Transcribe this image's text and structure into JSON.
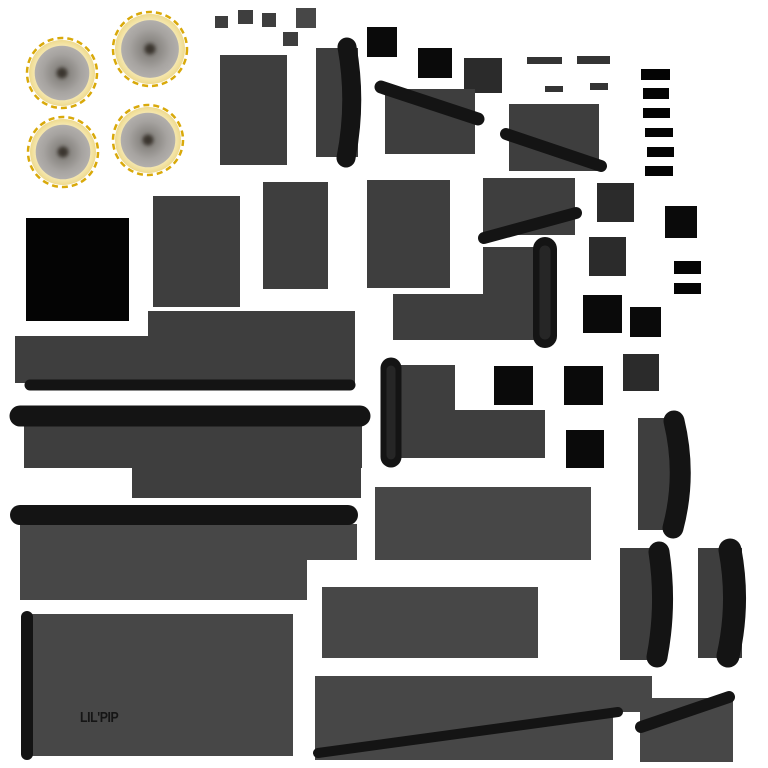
{
  "canvas": {
    "width": 768,
    "height": 768,
    "background": "#ffffff"
  },
  "palette": {
    "panel": "#3e3e3e",
    "panel_light": "#474747",
    "dark_square": "#2b2b2b",
    "black": "#0a0a0a",
    "black_deep": "#040404",
    "bar": "#141414",
    "bar_soft": "#262626",
    "strip": "#343434",
    "gold": "#d9a90a",
    "ring_cream": "#f6e9b4",
    "cone_gray": "#a6a3a0",
    "label_color": "#151515"
  },
  "label": {
    "text": "LIL'PIP"
  },
  "speakers": [
    {
      "cx": 62,
      "cy": 73,
      "r": 35,
      "rot": 25
    },
    {
      "cx": 150,
      "cy": 49,
      "r": 37,
      "rot": 35
    },
    {
      "cx": 63,
      "cy": 152,
      "r": 35,
      "rot": 30
    },
    {
      "cx": 148,
      "cy": 140,
      "r": 35,
      "rot": 20
    }
  ],
  "shapes": [
    {
      "n": "chip-a",
      "t": "rect",
      "x": 215,
      "y": 16,
      "w": 13,
      "h": 12,
      "c": "panel"
    },
    {
      "n": "chip-b",
      "t": "rect",
      "x": 238,
      "y": 10,
      "w": 15,
      "h": 14,
      "c": "panel"
    },
    {
      "n": "chip-c",
      "t": "rect",
      "x": 262,
      "y": 13,
      "w": 14,
      "h": 14,
      "c": "panel"
    },
    {
      "n": "chip-d",
      "t": "rect",
      "x": 296,
      "y": 8,
      "w": 20,
      "h": 20,
      "c": "panel_light"
    },
    {
      "n": "chip-e",
      "t": "rect",
      "x": 283,
      "y": 32,
      "w": 15,
      "h": 14,
      "c": "panel"
    },
    {
      "n": "panel-tall-left",
      "t": "rect",
      "x": 220,
      "y": 55,
      "w": 67,
      "h": 110,
      "c": "panel"
    },
    {
      "n": "strip-a",
      "t": "rect",
      "x": 527,
      "y": 57,
      "w": 35,
      "h": 7,
      "c": "strip"
    },
    {
      "n": "strip-b",
      "t": "rect",
      "x": 577,
      "y": 56,
      "w": 33,
      "h": 8,
      "c": "strip"
    },
    {
      "n": "strip-c",
      "t": "rect",
      "x": 545,
      "y": 86,
      "w": 18,
      "h": 6,
      "c": "strip"
    },
    {
      "n": "strip-d",
      "t": "rect",
      "x": 590,
      "y": 83,
      "w": 18,
      "h": 7,
      "c": "strip"
    },
    {
      "n": "square-dark-a",
      "t": "rect",
      "x": 464,
      "y": 58,
      "w": 38,
      "h": 35,
      "c": "dark_square"
    },
    {
      "n": "square-black-a",
      "t": "rect",
      "x": 367,
      "y": 27,
      "w": 30,
      "h": 30,
      "c": "black"
    },
    {
      "n": "square-black-b",
      "t": "rect",
      "x": 418,
      "y": 48,
      "w": 34,
      "h": 30,
      "c": "black"
    },
    {
      "n": "panel-mid-a",
      "t": "rect",
      "x": 385,
      "y": 89,
      "w": 90,
      "h": 65,
      "c": "panel"
    },
    {
      "n": "panel-mid-b",
      "t": "rect",
      "x": 509,
      "y": 104,
      "w": 90,
      "h": 67,
      "c": "panel"
    },
    {
      "n": "rung-1",
      "t": "rect",
      "x": 641,
      "y": 69,
      "w": 29,
      "h": 11,
      "c": "black_deep"
    },
    {
      "n": "rung-2",
      "t": "rect",
      "x": 643,
      "y": 88,
      "w": 26,
      "h": 11,
      "c": "black_deep"
    },
    {
      "n": "rung-3",
      "t": "rect",
      "x": 643,
      "y": 108,
      "w": 27,
      "h": 10,
      "c": "black_deep"
    },
    {
      "n": "rung-4",
      "t": "rect",
      "x": 645,
      "y": 128,
      "w": 28,
      "h": 9,
      "c": "black_deep"
    },
    {
      "n": "rung-5",
      "t": "rect",
      "x": 647,
      "y": 147,
      "w": 27,
      "h": 10,
      "c": "black_deep"
    },
    {
      "n": "rung-6",
      "t": "rect",
      "x": 645,
      "y": 166,
      "w": 28,
      "h": 10,
      "c": "black_deep"
    },
    {
      "n": "panel-row2-a",
      "t": "rect",
      "x": 153,
      "y": 196,
      "w": 87,
      "h": 111,
      "c": "panel"
    },
    {
      "n": "panel-row2-b",
      "t": "rect",
      "x": 263,
      "y": 182,
      "w": 65,
      "h": 107,
      "c": "panel"
    },
    {
      "n": "panel-row2-c",
      "t": "rect",
      "x": 367,
      "y": 180,
      "w": 83,
      "h": 108,
      "c": "panel"
    },
    {
      "n": "panel-row2-d",
      "t": "rect",
      "x": 483,
      "y": 178,
      "w": 92,
      "h": 57,
      "c": "panel"
    },
    {
      "n": "square-dark-b",
      "t": "rect",
      "x": 597,
      "y": 183,
      "w": 37,
      "h": 39,
      "c": "dark_square"
    },
    {
      "n": "square-black-c",
      "t": "rect",
      "x": 665,
      "y": 206,
      "w": 32,
      "h": 32,
      "c": "black"
    },
    {
      "n": "square-dark-c",
      "t": "rect",
      "x": 589,
      "y": 237,
      "w": 37,
      "h": 39,
      "c": "dark_square"
    },
    {
      "n": "tab-black-a",
      "t": "rect",
      "x": 674,
      "y": 261,
      "w": 27,
      "h": 13,
      "c": "black_deep"
    },
    {
      "n": "tab-black-b",
      "t": "rect",
      "x": 674,
      "y": 283,
      "w": 27,
      "h": 11,
      "c": "black_deep"
    },
    {
      "n": "square-black-large",
      "t": "rect",
      "x": 26,
      "y": 218,
      "w": 103,
      "h": 103,
      "c": "black_deep"
    },
    {
      "n": "bracket-vertical",
      "t": "rect",
      "x": 483,
      "y": 247,
      "w": 58,
      "h": 93,
      "c": "panel"
    },
    {
      "n": "bracket-horizontal",
      "t": "rect",
      "x": 393,
      "y": 294,
      "w": 148,
      "h": 46,
      "c": "panel"
    },
    {
      "n": "panel-band-a",
      "t": "rect",
      "x": 148,
      "y": 311,
      "w": 207,
      "h": 70,
      "c": "panel"
    },
    {
      "n": "panel-band-b",
      "t": "rect",
      "x": 15,
      "y": 336,
      "w": 340,
      "h": 47,
      "c": "panel"
    },
    {
      "n": "square-black-d",
      "t": "rect",
      "x": 583,
      "y": 295,
      "w": 39,
      "h": 38,
      "c": "black"
    },
    {
      "n": "square-black-e",
      "t": "rect",
      "x": 630,
      "y": 307,
      "w": 31,
      "h": 30,
      "c": "black"
    },
    {
      "n": "square-dark-d",
      "t": "rect",
      "x": 623,
      "y": 354,
      "w": 36,
      "h": 37,
      "c": "dark_square"
    },
    {
      "n": "square-black-f",
      "t": "rect",
      "x": 494,
      "y": 366,
      "w": 39,
      "h": 39,
      "c": "black"
    },
    {
      "n": "square-black-g",
      "t": "rect",
      "x": 564,
      "y": 366,
      "w": 39,
      "h": 39,
      "c": "black"
    },
    {
      "n": "panel-step-a",
      "t": "rect",
      "x": 392,
      "y": 365,
      "w": 63,
      "h": 93,
      "c": "panel"
    },
    {
      "n": "panel-step-b",
      "t": "rect",
      "x": 392,
      "y": 410,
      "w": 153,
      "h": 48,
      "c": "panel"
    },
    {
      "n": "square-black-h",
      "t": "rect",
      "x": 566,
      "y": 430,
      "w": 38,
      "h": 38,
      "c": "black"
    },
    {
      "n": "panel-band-c",
      "t": "rect",
      "x": 24,
      "y": 421,
      "w": 338,
      "h": 47,
      "c": "panel"
    },
    {
      "n": "panel-band-c2",
      "t": "rect",
      "x": 132,
      "y": 468,
      "w": 229,
      "h": 30,
      "c": "panel"
    },
    {
      "n": "panel-band-d",
      "t": "rect",
      "x": 20,
      "y": 524,
      "w": 337,
      "h": 36,
      "c": "panel_light"
    },
    {
      "n": "panel-band-d2",
      "t": "rect",
      "x": 20,
      "y": 560,
      "w": 287,
      "h": 40,
      "c": "panel_light"
    },
    {
      "n": "panel-wide-e",
      "t": "rect",
      "x": 375,
      "y": 487,
      "w": 216,
      "h": 73,
      "c": "panel_light"
    },
    {
      "n": "blade-a-fill",
      "t": "rect",
      "x": 638,
      "y": 418,
      "w": 34,
      "h": 112,
      "c": "panel"
    },
    {
      "n": "blade-b-fill",
      "t": "rect",
      "x": 620,
      "y": 548,
      "w": 45,
      "h": 112,
      "c": "panel"
    },
    {
      "n": "blade-c-fill",
      "t": "rect",
      "x": 698,
      "y": 548,
      "w": 44,
      "h": 110,
      "c": "panel"
    },
    {
      "n": "panel-bottom-a",
      "t": "rect",
      "x": 322,
      "y": 587,
      "w": 216,
      "h": 71,
      "c": "panel_light"
    },
    {
      "n": "speaker-panel",
      "t": "rect",
      "x": 28,
      "y": 614,
      "w": 265,
      "h": 142,
      "c": "panel_light"
    },
    {
      "n": "panel-bottom-b",
      "t": "rect",
      "x": 315,
      "y": 676,
      "w": 337,
      "h": 36,
      "c": "panel_light"
    },
    {
      "n": "panel-bottom-b2",
      "t": "rect",
      "x": 315,
      "y": 712,
      "w": 298,
      "h": 48,
      "c": "panel_light"
    },
    {
      "n": "panel-bottom-c",
      "t": "rect",
      "x": 640,
      "y": 698,
      "w": 93,
      "h": 64,
      "c": "panel_light"
    },
    {
      "n": "lens-fill",
      "t": "rect",
      "x": 316,
      "y": 48,
      "w": 42,
      "h": 109,
      "c": "panel"
    },
    {
      "n": "lens-curve",
      "t": "path",
      "d": "M347,47 Q357,102 346,158",
      "w": 19,
      "c": "bar"
    },
    {
      "n": "strut-diag-a",
      "t": "line",
      "x1": 381,
      "y1": 87,
      "x2": 478,
      "y2": 119,
      "w": 13,
      "c": "bar"
    },
    {
      "n": "strut-diag-b",
      "t": "line",
      "x1": 506,
      "y1": 134,
      "x2": 601,
      "y2": 166,
      "w": 12,
      "c": "bar"
    },
    {
      "n": "strut-diag-c",
      "t": "line",
      "x1": 484,
      "y1": 238,
      "x2": 576,
      "y2": 213,
      "w": 12,
      "c": "bar"
    },
    {
      "n": "roll-bar",
      "t": "line",
      "x1": 545,
      "y1": 249,
      "x2": 545,
      "y2": 336,
      "w": 24,
      "c": "bar"
    },
    {
      "n": "roll-bar-core",
      "t": "line",
      "x1": 545,
      "y1": 251,
      "x2": 545,
      "y2": 334,
      "w": 11,
      "c": "bar_soft"
    },
    {
      "n": "edge-bar-a",
      "t": "line",
      "x1": 30,
      "y1": 385,
      "x2": 350,
      "y2": 385,
      "w": 11,
      "c": "bar"
    },
    {
      "n": "edge-bar-b",
      "t": "line",
      "x1": 20,
      "y1": 416,
      "x2": 360,
      "y2": 416,
      "w": 21,
      "c": "bar"
    },
    {
      "n": "edge-bar-c",
      "t": "line",
      "x1": 20,
      "y1": 515,
      "x2": 348,
      "y2": 515,
      "w": 20,
      "c": "bar"
    },
    {
      "n": "post-bar",
      "t": "line",
      "x1": 391,
      "y1": 368,
      "x2": 391,
      "y2": 457,
      "w": 21,
      "c": "bar"
    },
    {
      "n": "post-bar-core",
      "t": "line",
      "x1": 391,
      "y1": 370,
      "x2": 391,
      "y2": 455,
      "w": 9,
      "c": "bar_soft"
    },
    {
      "n": "blade-a-curve",
      "t": "path",
      "d": "M674,421 Q687,475 673,528",
      "w": 21,
      "c": "bar"
    },
    {
      "n": "blade-b-curve",
      "t": "path",
      "d": "M659,552 Q667,605 657,657",
      "w": 21,
      "c": "bar"
    },
    {
      "n": "blade-c-curve",
      "t": "path",
      "d": "M730,550 Q740,603 728,656",
      "w": 23,
      "c": "bar"
    },
    {
      "n": "side-post-bar",
      "t": "line",
      "x1": 27,
      "y1": 617,
      "x2": 27,
      "y2": 754,
      "w": 12,
      "c": "bar"
    },
    {
      "n": "long-diag-bar",
      "t": "line",
      "x1": 318,
      "y1": 753,
      "x2": 618,
      "y2": 712,
      "w": 10,
      "c": "bar"
    },
    {
      "n": "corner-diag-bar",
      "t": "line",
      "x1": 641,
      "y1": 727,
      "x2": 729,
      "y2": 697,
      "w": 12,
      "c": "bar"
    }
  ]
}
